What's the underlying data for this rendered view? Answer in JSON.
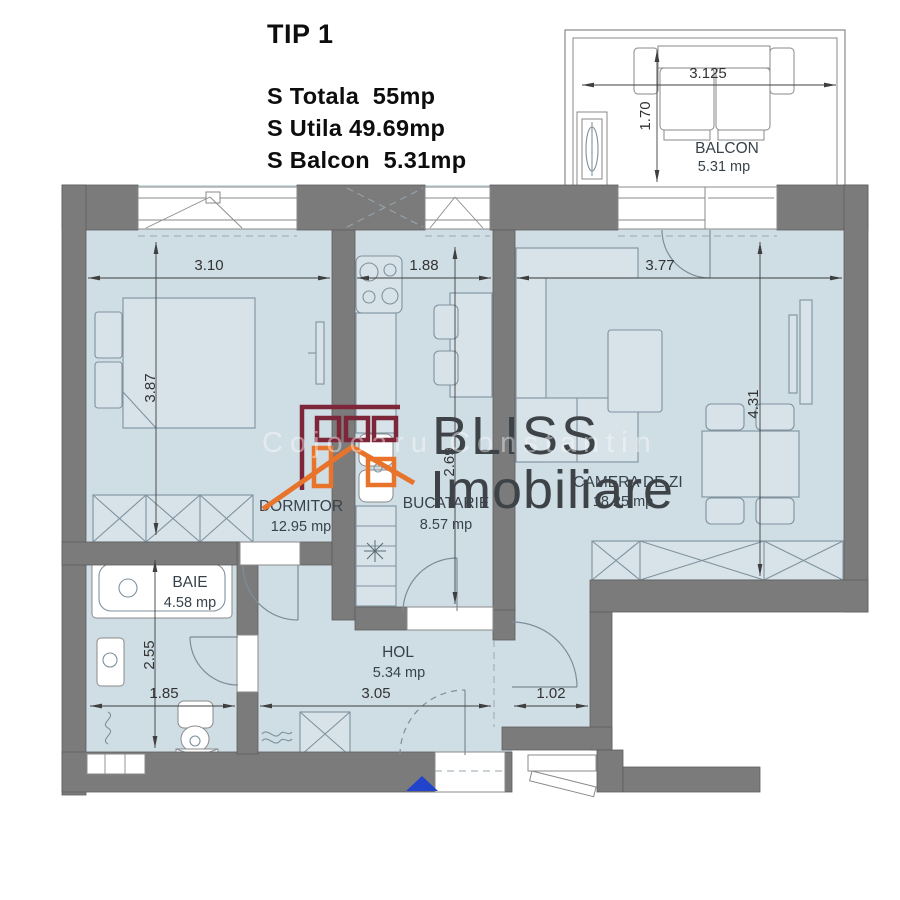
{
  "header": {
    "title": "TIP 1",
    "specs": [
      "S Totala  55mp",
      "S Utila 49.69mp",
      "S Balcon  5.31mp"
    ]
  },
  "rooms": {
    "dormitor": {
      "name": "DORMITOR",
      "area": "12.95 mp"
    },
    "bucatarie": {
      "name": "BUCATARIE",
      "area": "8.57 mp"
    },
    "camera_de_zi": {
      "name": "CAMERA DE ZI",
      "area": "18.25 mp"
    },
    "baie": {
      "name": "BAIE",
      "area": "4.58 mp"
    },
    "hol": {
      "name": "HOL",
      "area": "5.34 mp"
    },
    "balcon": {
      "name": "BALCON",
      "area": "5.31 mp"
    }
  },
  "dims": {
    "bedroom_w": "3.10",
    "kitchen_w": "1.88",
    "living_w": "3.77",
    "bedroom_h": "3.87",
    "kitchen_h": "2.69",
    "living_h": "4.31",
    "bath_h": "2.55",
    "bath_w": "1.85",
    "hol_w": "3.05",
    "entry_w": "1.02",
    "balcony_w": "3.125",
    "balcony_h": "1.70"
  },
  "logo": {
    "brand_top": "BLISS",
    "brand_bottom": "Imobiliare",
    "watermark": "Cojocaru Constantin"
  },
  "colors": {
    "wall": "#7b7b7b",
    "floor": "#cfdde5",
    "logo_maroon": "#7e2639",
    "logo_orange": "#e8742c",
    "entrance_marker": "#2244cc"
  }
}
